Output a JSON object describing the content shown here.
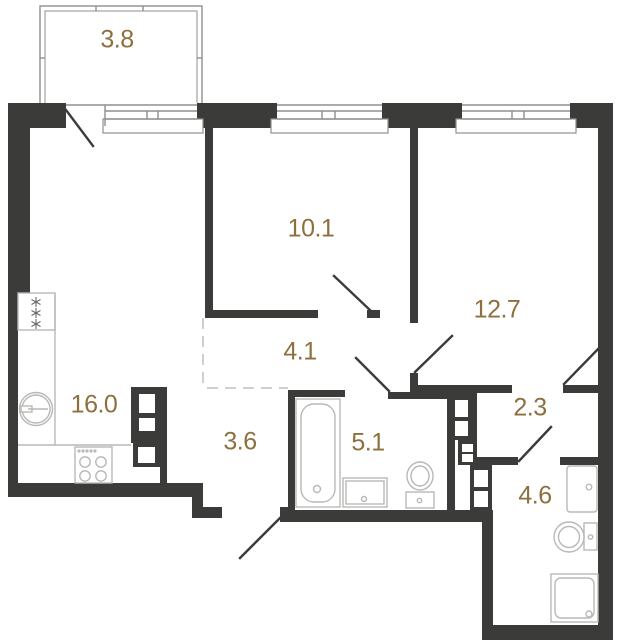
{
  "colors": {
    "wall": "#3b3b39",
    "label": "#8e6f3e",
    "line": "#8f8f8d",
    "fixture": "#b8b8b6",
    "dash": "#cfcfcd"
  },
  "rooms": [
    {
      "id": "balcony",
      "area": "3.8"
    },
    {
      "id": "bedroom",
      "area": "10.1"
    },
    {
      "id": "room-2",
      "area": "12.7"
    },
    {
      "id": "hallway",
      "area": "4.1"
    },
    {
      "id": "kitchen-living-room",
      "area": "16.0"
    },
    {
      "id": "entry-hall",
      "area": "3.6"
    },
    {
      "id": "bathroom",
      "area": "5.1"
    },
    {
      "id": "corridor",
      "area": "2.3"
    },
    {
      "id": "bathroom-2",
      "area": "4.6"
    }
  ]
}
